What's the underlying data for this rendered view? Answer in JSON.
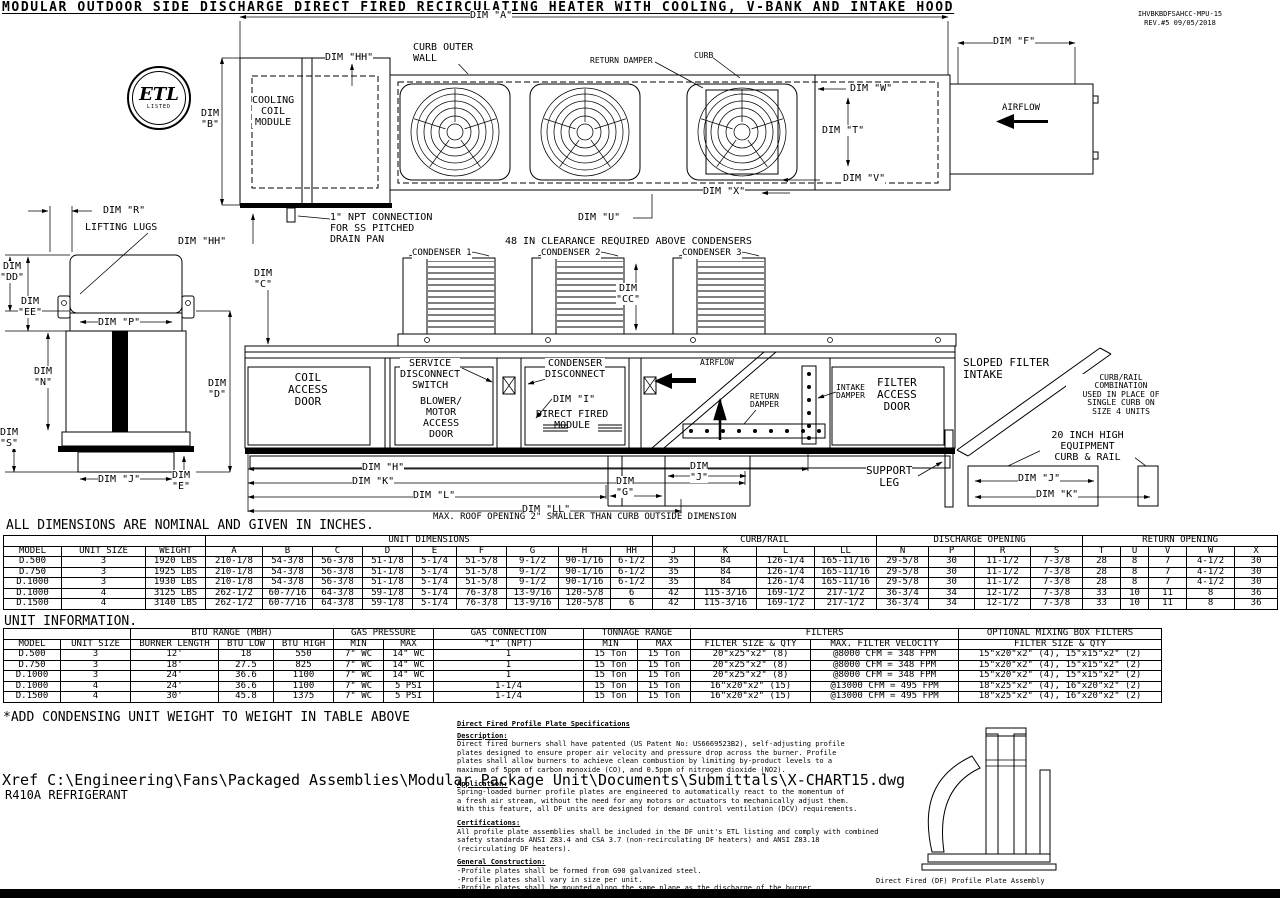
{
  "title": "MODULAR OUTDOOR SIDE DISCHARGE DIRECT FIRED RECIRCULATING HEATER WITH COOLING, V-BANK AND INTAKE HOOD",
  "doc": {
    "number": "IHVBKBDFSAHCC-MPU-15",
    "revision": "REV.#5   09/05/2018"
  },
  "etl": {
    "mark": "ETL",
    "listed": "LISTED"
  },
  "drawing": {
    "dim_a": "DIM \"A\"",
    "dim_f": "DIM \"F\"",
    "dim_b": "DIM\n\"B\"",
    "dim_hh_top": "DIM \"HH\"",
    "curb_outer_wall": "CURB OUTER\nWALL",
    "return_damper_top": "RETURN DAMPER",
    "curb_top": "CURB",
    "cooling_coil_module": "COOLING\nCOIL\nMODULE",
    "dim_w": "DIM \"W\"",
    "dim_t": "DIM \"T\"",
    "dim_v": "DIM \"V\"",
    "dim_x": "DIM \"X\"",
    "dim_u": "DIM \"U\"",
    "airflow_top": "AIRFLOW",
    "dim_r": "DIM \"R\"",
    "lifting_lugs": "LIFTING LUGS",
    "dim_hh_mid": "DIM \"HH\"",
    "npt_note": "1\" NPT CONNECTION\nFOR SS PITCHED\nDRAIN PAN",
    "clearance_note": "48 IN CLEARANCE REQUIRED ABOVE CONDENSERS",
    "condenser1": "CONDENSER 1",
    "condenser2": "CONDENSER 2",
    "condenser3": "CONDENSER 3",
    "dim_c": "DIM\n\"C\"",
    "dim_cc": "DIM\n\"CC\"",
    "dim_dd": "DIM\n\"DD\"",
    "dim_ee": "DIM\n\"EE\"",
    "dim_p": "DIM \"P\"",
    "dim_n": "DIM\n\"N\"",
    "dim_d": "DIM\n\"D\"",
    "dim_s": "DIM\n\"S\"",
    "dim_j_left": "DIM \"J\"",
    "dim_e": "DIM\n\"E\"",
    "coil_access_door": "COIL\nACCESS\nDOOR",
    "service_disconnect": "SERVICE\nDISCONNECT\nSWITCH",
    "blower_motor": "BLOWER/\nMOTOR\nACCESS\nDOOR",
    "condenser_disconnect": "CONDENSER\nDISCONNECT",
    "dim_i": "DIM \"I\"",
    "direct_fired_module": "DIRECT FIRED\nMODULE",
    "airflow_mid": "AIRFLOW",
    "return_damper_mid": "RETURN\nDAMPER",
    "intake_damper": "INTAKE\nDAMPER",
    "filter_access_door": "FILTER\nACCESS\nDOOR",
    "sloped_filter_intake": "SLOPED FILTER\nINTAKE",
    "curb_rail_note": "CURB/RAIL\nCOMBINATION\nUSED IN PLACE OF\nSINGLE CURB ON\nSIZE 4 UNITS",
    "equip_curb_note": "20 INCH HIGH\nEQUIPMENT\nCURB & RAIL",
    "support_leg": "SUPPORT\nLEG",
    "dim_j_right": "DIM \"J\"",
    "dim_k_right": "DIM \"K\"",
    "dim_h": "DIM \"H\"",
    "dim_k_bottom": "DIM \"K\"",
    "dim_l": "DIM \"L\"",
    "dim_ll": "DIM \"LL\"",
    "dim_g": "DIM\n\"G\"",
    "dim_j_bottom": "DIM\n\"J\"",
    "max_roof_note": "MAX. ROOF OPENING 2\" SMALLER THAN CURB OUTSIDE DIMENSION"
  },
  "notes": {
    "dimensions_note": "ALL DIMENSIONS ARE NOMINAL AND GIVEN IN INCHES.",
    "unit_information": "UNIT INFORMATION.",
    "weight_note": "*ADD CONDENSING UNIT WEIGHT TO WEIGHT IN TABLE ABOVE",
    "xref": "Xref C:\\Engineering\\Fans\\Packaged Assemblies\\Modular Package Unit\\Documents\\Submittals\\X-CHART15.dwg",
    "refrigerant": "R410A REFRIGERANT"
  },
  "dim_table": {
    "groups": {
      "unit_dimensions": "UNIT DIMENSIONS",
      "curb_rail": "CURB/RAIL",
      "discharge_opening": "DISCHARGE OPENING",
      "return_opening": "RETURN OPENING"
    },
    "columns": [
      "MODEL",
      "UNIT SIZE",
      "WEIGHT",
      "A",
      "B",
      "C",
      "D",
      "E",
      "F",
      "G",
      "H",
      "HH",
      "J",
      "K",
      "L",
      "LL",
      "N",
      "P",
      "R",
      "S",
      "T",
      "U",
      "V",
      "W",
      "X"
    ],
    "rows": [
      [
        "D.500",
        "3",
        "1920 LBS",
        "210-1/8",
        "54-3/8",
        "56-3/8",
        "51-1/8",
        "5-1/4",
        "51-5/8",
        "9-1/2",
        "90-1/16",
        "6-1/2",
        "35",
        "84",
        "126-1/4",
        "165-11/16",
        "29-5/8",
        "30",
        "11-1/2",
        "7-3/8",
        "28",
        "8",
        "7",
        "4-1/2",
        "30"
      ],
      [
        "D.750",
        "3",
        "1925 LBS",
        "210-1/8",
        "54-3/8",
        "56-3/8",
        "51-1/8",
        "5-1/4",
        "51-5/8",
        "9-1/2",
        "90-1/16",
        "6-1/2",
        "35",
        "84",
        "126-1/4",
        "165-11/16",
        "29-5/8",
        "30",
        "11-1/2",
        "7-3/8",
        "28",
        "8",
        "7",
        "4-1/2",
        "30"
      ],
      [
        "D.1000",
        "3",
        "1930 LBS",
        "210-1/8",
        "54-3/8",
        "56-3/8",
        "51-1/8",
        "5-1/4",
        "51-5/8",
        "9-1/2",
        "90-1/16",
        "6-1/2",
        "35",
        "84",
        "126-1/4",
        "165-11/16",
        "29-5/8",
        "30",
        "11-1/2",
        "7-3/8",
        "28",
        "8",
        "7",
        "4-1/2",
        "30"
      ],
      [
        "D.1000",
        "4",
        "3125 LBS",
        "262-1/2",
        "60-7/16",
        "64-3/8",
        "59-1/8",
        "5-1/4",
        "76-3/8",
        "13-9/16",
        "120-5/8",
        "6",
        "42",
        "115-3/16",
        "169-1/2",
        "217-1/2",
        "36-3/4",
        "34",
        "12-1/2",
        "7-3/8",
        "33",
        "10",
        "11",
        "8",
        "36"
      ],
      [
        "D.1500",
        "4",
        "3140 LBS",
        "262-1/2",
        "60-7/16",
        "64-3/8",
        "59-1/8",
        "5-1/4",
        "76-3/8",
        "13-9/16",
        "120-5/8",
        "6",
        "42",
        "115-3/16",
        "169-1/2",
        "217-1/2",
        "36-3/4",
        "34",
        "12-1/2",
        "7-3/8",
        "33",
        "10",
        "11",
        "8",
        "36"
      ]
    ]
  },
  "info_table": {
    "groups": {
      "btu_range": "BTU RANGE (MBH)",
      "gas_pressure": "GAS PRESSURE",
      "gas_connection": "GAS CONNECTION",
      "tonnage_range": "TONNAGE RANGE",
      "filters": "FILTERS",
      "mixing_box": "OPTIONAL MIXING BOX FILTERS"
    },
    "columns": [
      "MODEL",
      "UNIT SIZE",
      "BURNER LENGTH",
      "BTU LOW",
      "BTU HIGH",
      "MIN",
      "MAX",
      "\"I\" (NPT)",
      "MIN",
      "MAX",
      "FILTER SIZE & QTY",
      "MAX. FILTER VELOCITY",
      "FILTER SIZE & QTY"
    ],
    "rows": [
      [
        "D.500",
        "3",
        "12'",
        "18",
        "550",
        "7\" WC",
        "14\" WC",
        "1",
        "15 Ton",
        "15 Ton",
        "20\"x25\"x2\" (8)",
        "@8000 CFM = 348 FPM",
        "15\"x20\"x2\" (4), 15\"x15\"x2\" (2)"
      ],
      [
        "D.750",
        "3",
        "18'",
        "27.5",
        "825",
        "7\" WC",
        "14\" WC",
        "1",
        "15 Ton",
        "15 Ton",
        "20\"x25\"x2\" (8)",
        "@8000 CFM = 348 FPM",
        "15\"x20\"x2\" (4), 15\"x15\"x2\" (2)"
      ],
      [
        "D.1000",
        "3",
        "24'",
        "36.6",
        "1100",
        "7\" WC",
        "14\" WC",
        "1",
        "15 Ton",
        "15 Ton",
        "20\"x25\"x2\" (8)",
        "@8000 CFM = 348 FPM",
        "15\"x20\"x2\" (4), 15\"x15\"x2\" (2)"
      ],
      [
        "D.1000",
        "4",
        "24'",
        "36.6",
        "1100",
        "7\" WC",
        "5 PSI",
        "1-1/4",
        "15 Ton",
        "15 Ton",
        "16\"x20\"x2\" (15)",
        "@13000 CFM = 495 FPM",
        "18\"x25\"x2\" (4), 16\"x20\"x2\" (2)"
      ],
      [
        "D.1500",
        "4",
        "30'",
        "45.8",
        "1375",
        "7\" WC",
        "5 PSI",
        "1-1/4",
        "15 Ton",
        "15 Ton",
        "16\"x20\"x2\" (15)",
        "@13000 CFM = 495 FPM",
        "18\"x25\"x2\" (4), 16\"x20\"x2\" (2)"
      ]
    ]
  },
  "spec": {
    "heading": "Direct Fired Profile Plate Specifications",
    "sections": [
      {
        "label": "Description:",
        "body": "Direct fired burners shall have patented (US Patent No: US6669523B2), self-adjusting profile\nplates designed to ensure proper air velocity and pressure drop across the burner. Profile\nplates shall allow burners to achieve clean combustion by limiting by-product levels to a\nmaximum of 5ppm of carbon monoxide (CO), and 0.5ppm of nitrogen dioxide (NO2)."
      },
      {
        "label": "Application:",
        "body": "Spring-loaded burner profile plates are engineered to automatically react to the momentum of\na fresh air stream, without the need for any motors or actuators to mechanically adjust them.\nWith this feature, all DF units are designed for demand control ventilation (DCV) requirements."
      },
      {
        "label": "Certifications:",
        "body": "All profile plate assemblies shall be included in the DF unit's ETL listing and comply with combined\nsafety standards ANSI Z83.4 and CSA 3.7 (non-recirculating DF heaters) and ANSI Z83.18\n(recirculating DF heaters)."
      },
      {
        "label": "General Construction:",
        "body": "-Profile plates shall be formed from G90 galvanized steel.\n-Profile plates shall vary in size per unit.\n-Profile plates shall be mounted along the same plane as the discharge of the burner.\n-Design shall incorporate properly torqued, permanently mounted spring hinges.\n-Spring hinges shall be made from plated steel."
      }
    ],
    "caption": "Direct Fired (DF) Profile Plate Assembly"
  }
}
